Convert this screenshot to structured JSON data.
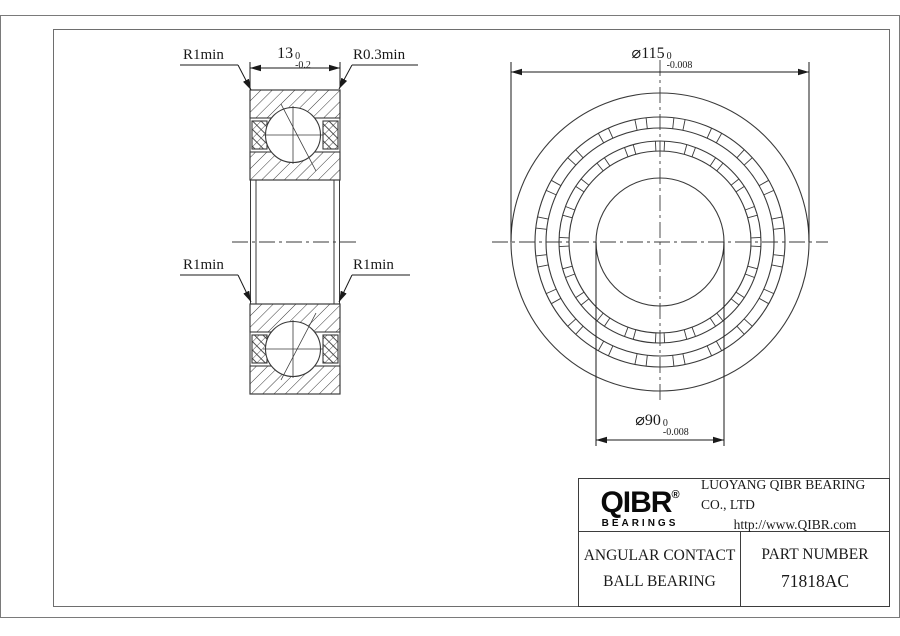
{
  "colors": {
    "line": "#3a3a3a",
    "frame": "#7a7a7a",
    "text": "#1a1a1a",
    "background": "#ffffff"
  },
  "section_view": {
    "label_r_top_left": "R1min",
    "label_r_top_right": "R0.3min",
    "label_r_mid_left": "R1min",
    "label_r_mid_right": "R1min",
    "width_dim": {
      "value": "13",
      "tol_upper": "0",
      "tol_lower": "-0.2"
    }
  },
  "front_view": {
    "outer_dia_dim": {
      "value": "⌀115",
      "tol_upper": "0",
      "tol_lower": "-0.008"
    },
    "bore_dia_dim": {
      "value": "⌀90",
      "tol_upper": "0",
      "tol_lower": "-0.008"
    }
  },
  "title_block": {
    "logo_text": "QIBR",
    "logo_registered": "®",
    "logo_subtext": "BEARINGS",
    "company_name": "LUOYANG QIBR BEARING CO., LTD",
    "website": "http://www.QIBR.com",
    "product_type_line1": "ANGULAR CONTACT",
    "product_type_line2": "BALL BEARING",
    "part_number_label": "PART NUMBER",
    "part_number": "71818AC"
  }
}
